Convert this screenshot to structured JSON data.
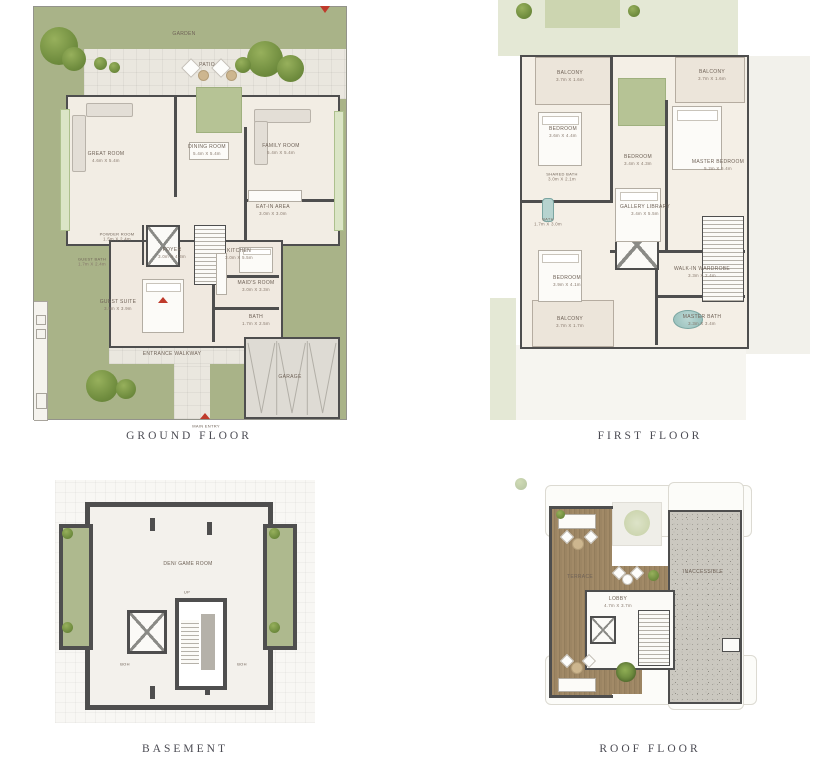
{
  "colors": {
    "garden_green": "#a9b388",
    "wall_dark": "#4e4e4e",
    "accent_red": "#bf3a2b",
    "deck_wood": "#9c8568",
    "window_green": "#dbe5c6",
    "gravel_gray": "#cbc8c0"
  },
  "captions": {
    "ground": "GROUND FLOOR",
    "first": "FIRST FLOOR",
    "basement": "BASEMENT",
    "roof": "ROOF FLOOR"
  },
  "ground": {
    "garden": "GARDEN",
    "patio": "PATIO",
    "entrance_walkway": "ENTRANCE WALKWAY",
    "main_entry": "MAIN ENTRY",
    "garage": "GARAGE",
    "rooms": {
      "great_room": {
        "name": "GREAT ROOM",
        "dims": "4.6m X 5.4m"
      },
      "dining_room": {
        "name": "DINING ROOM",
        "dims": "5.4m X 5.4m"
      },
      "family_room": {
        "name": "FAMILY ROOM",
        "dims": "5.4m X 5.4m"
      },
      "eat_in_area": {
        "name": "EAT-IN AREA",
        "dims": "3.0m X 3.0m"
      },
      "kitchen": {
        "name": "KITCHEN",
        "dims": "3.0m X 5.5m"
      },
      "maids_room": {
        "name": "MAID'S ROOM",
        "dims": "3.0m X 3.3m"
      },
      "bath": {
        "name": "BATH",
        "dims": "1.7m X 2.5m"
      },
      "foyer": {
        "name": "FOYER",
        "dims": "3.0m X 4.3m"
      },
      "powder_room": {
        "name": "POWDER ROOM",
        "dims": "1.5m X 2.4m"
      },
      "guest_bath": {
        "name": "GUEST BATH",
        "dims": "1.7m X 2.4m"
      },
      "guest_suite": {
        "name": "GUEST SUITE",
        "dims": "3.9m X 3.9m"
      }
    }
  },
  "first": {
    "rooms": {
      "balcony_tl": {
        "name": "BALCONY",
        "dims": "3.7m X 1.6m"
      },
      "bedroom_tl": {
        "name": "BEDROOM",
        "dims": "3.6m X 4.4m"
      },
      "shared_bath": {
        "name": "SHARED BATH",
        "dims": "3.0m X 2.1m"
      },
      "bath": {
        "name": "BATH",
        "dims": "1.7m X 3.0m"
      },
      "bedroom_mid": {
        "name": "BEDROOM",
        "dims": "3.4m X 4.3m"
      },
      "gallery_library": {
        "name": "GALLERY LIBRARY",
        "dims": "3.4m X 5.5m"
      },
      "bedroom_bl": {
        "name": "BEDROOM",
        "dims": "3.9m X 4.1m"
      },
      "balcony_bl": {
        "name": "BALCONY",
        "dims": "3.7m X 1.7m"
      },
      "master_bedroom": {
        "name": "MASTER BEDROOM",
        "dims": "5.2m X 5.4m"
      },
      "balcony_tr": {
        "name": "BALCONY",
        "dims": "3.7m X 1.6m"
      },
      "walk_in_wardrobe": {
        "name": "WALK-IN WARDROBE",
        "dims": "3.3m X 2.4m"
      },
      "master_bath": {
        "name": "MASTER BATH",
        "dims": "3.3m X 3.4m"
      }
    }
  },
  "basement": {
    "rooms": {
      "den": {
        "name": "DEN/ GAME ROOM"
      },
      "boh_left": {
        "name": "BOH"
      },
      "boh_right": {
        "name": "BOH"
      },
      "up": {
        "name": "UP"
      }
    }
  },
  "roof": {
    "rooms": {
      "terrace": {
        "name": "TERRACE"
      },
      "lobby": {
        "name": "LOBBY",
        "dims": "4.7m X 3.7m"
      },
      "inaccessible": {
        "name": "INACCESSIBLE"
      }
    }
  }
}
